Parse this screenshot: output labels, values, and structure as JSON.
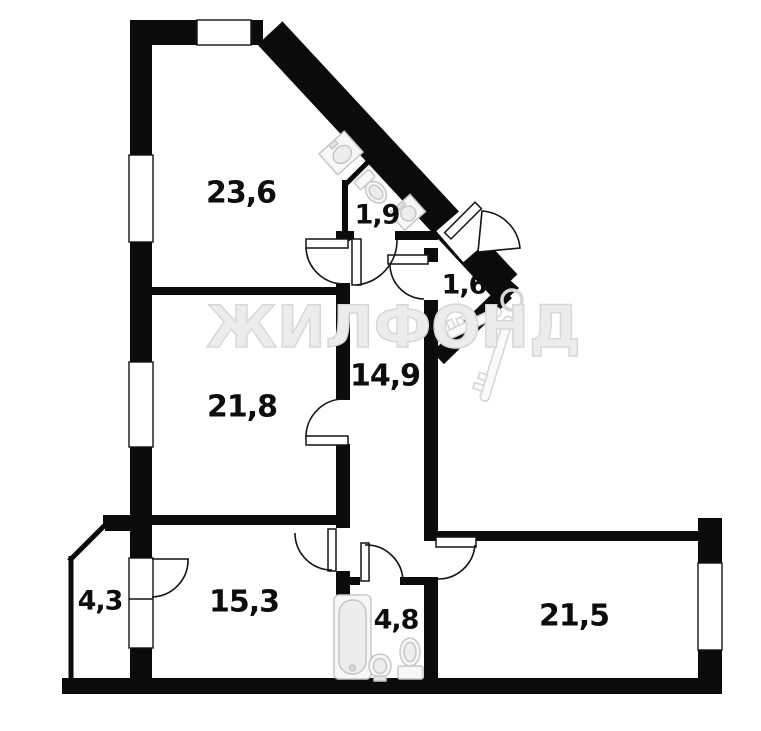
{
  "watermark": {
    "brand": "ЖИЛФОНД"
  },
  "rooms": [
    {
      "id": "room-top-left",
      "area": "23,6"
    },
    {
      "id": "wc",
      "area": "1,9"
    },
    {
      "id": "entry-bay",
      "area": "1,6"
    },
    {
      "id": "room-mid-left",
      "area": "21,8"
    },
    {
      "id": "hallway",
      "area": "14,9"
    },
    {
      "id": "balcony",
      "area": "4,3"
    },
    {
      "id": "room-bottom-left",
      "area": "15,3"
    },
    {
      "id": "bathroom",
      "area": "4,8"
    },
    {
      "id": "room-bottom-right",
      "area": "21,5"
    }
  ],
  "colors": {
    "walls": "#0b0b0b",
    "background": "#ffffff",
    "watermark": "#ececec",
    "fixtures": "#d6d6d6"
  }
}
